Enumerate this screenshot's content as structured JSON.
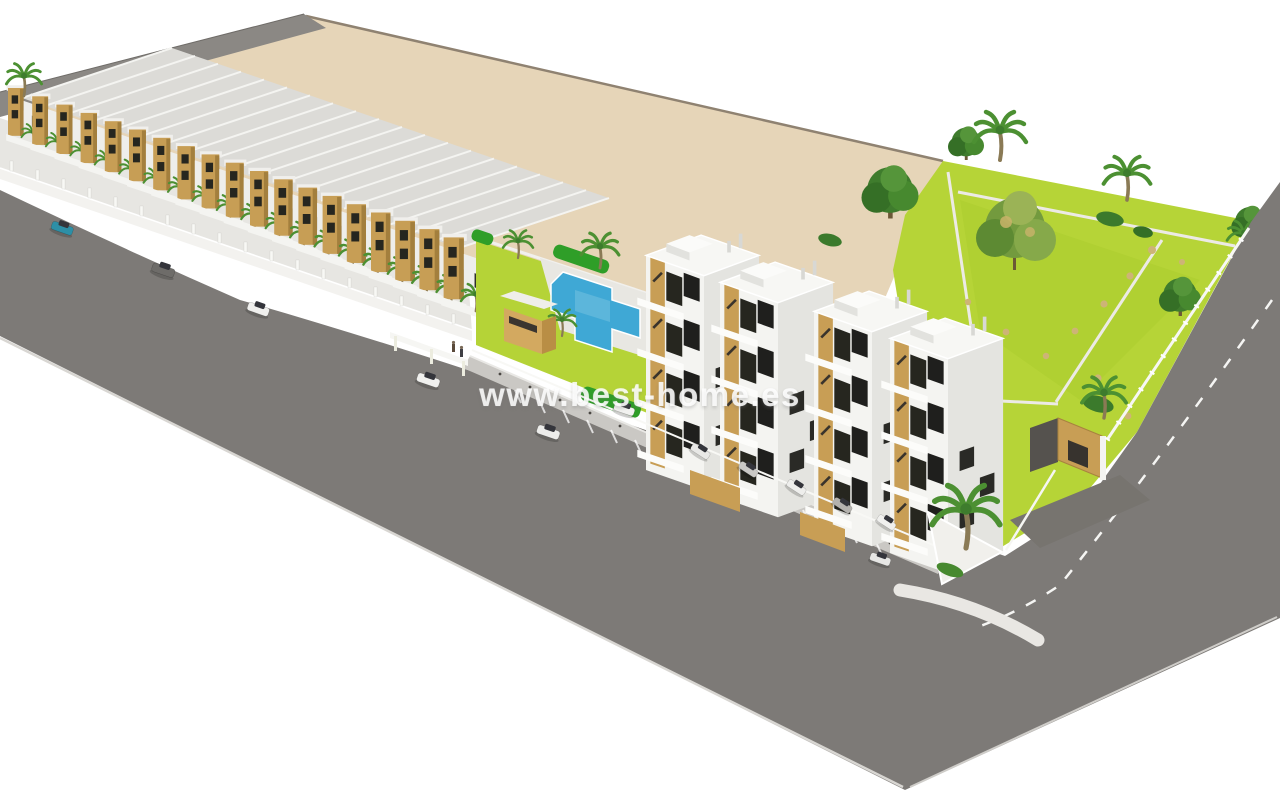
{
  "watermark": {
    "text": "www.best-home.es"
  },
  "scene": {
    "label": "aerial 3d render of residential development",
    "townhouse_row": {
      "label": "row of terraced townhouses",
      "unit_count": 19
    },
    "apartment_blocks": {
      "label": "apartment buildings",
      "block_count": 2,
      "visible_floor_count": 4
    },
    "pool_area": {
      "label": "communal swimming pool"
    },
    "garden": {
      "label": "landscaped garden with palm trees"
    },
    "vacant_land": {
      "label": "vacant beige plot"
    },
    "roads": {
      "label": "perimeter streets",
      "marking": "white dashed center line",
      "parking": "angled parking bays"
    },
    "cars": {
      "count": 12,
      "colors": [
        "teal",
        "white",
        "gray"
      ]
    }
  },
  "palette": {
    "background": "#ffffff",
    "road": "#7d7a77",
    "back_road": "#8b8884",
    "vacant_land": "#e6d5b8",
    "garden_green": "#b6d437",
    "hedge_green": "#2f9e28",
    "palm_green": "#4c9032",
    "pool_blue": "#3fa8d5",
    "wood_accent": "#c89e55",
    "building_white": "#f3f3f0",
    "roof_gray": "#dbdad6",
    "window_dark": "#23231f",
    "sidewalk": "#cac8c4",
    "car_teal": "#2d8fa6"
  }
}
